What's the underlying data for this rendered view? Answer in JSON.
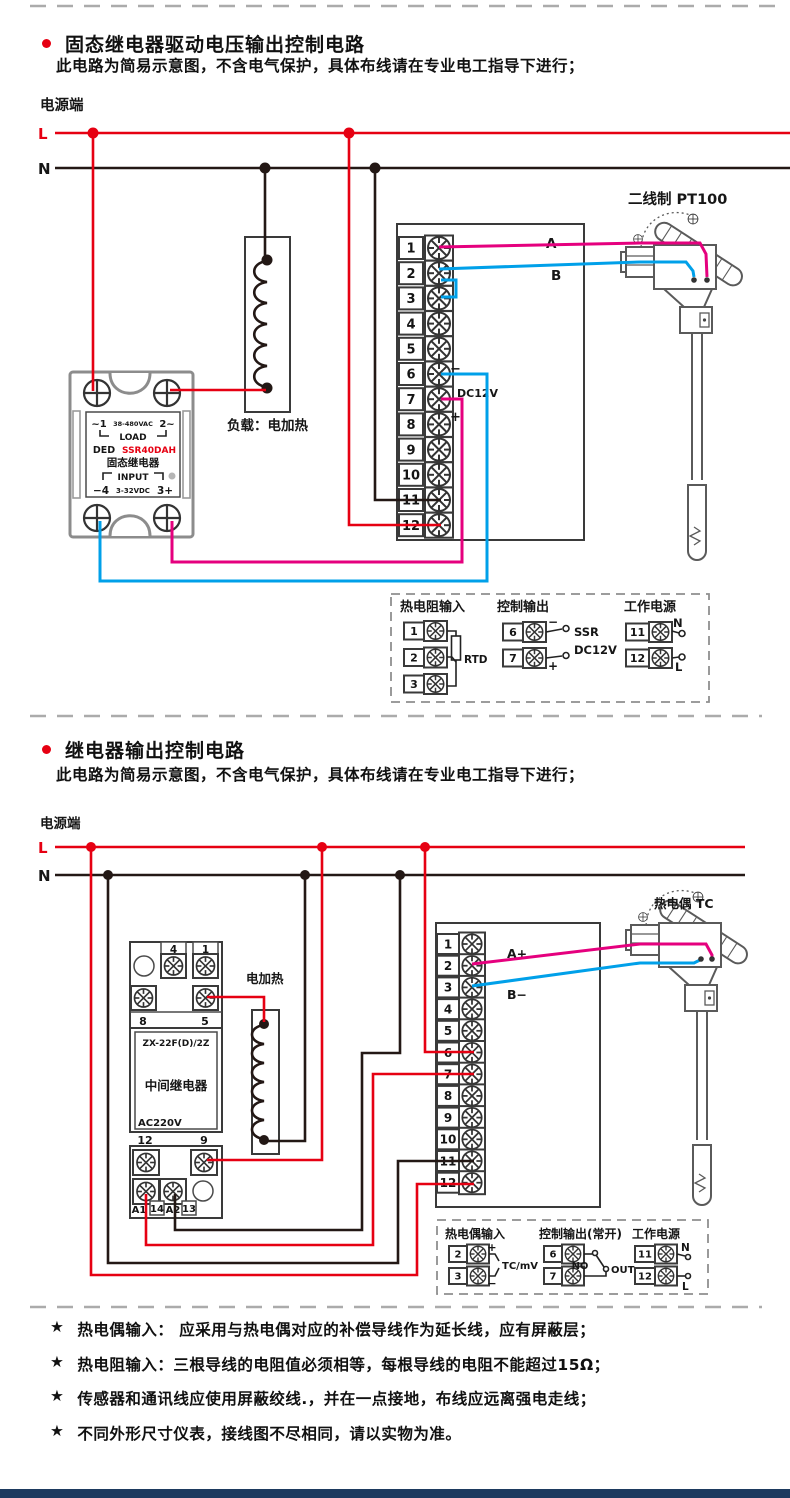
{
  "colors": {
    "wire_live": "#e60012",
    "wire_neutral": "#231815",
    "wire_sensor_a": "#e5007e",
    "wire_sensor_b": "#00a0e9",
    "accent": "#e60012",
    "footer_bar": "#1d3a5f"
  },
  "section1": {
    "title": "固态继电器驱动电压输出控制电路",
    "subtitle": "此电路为简易示意图，不含电气保护，具体布线请在专业电工指导下进行；",
    "power_label": "电源端",
    "live_label": "L",
    "neutral_label": "N",
    "ssr": {
      "top_left": "~1",
      "voltage_ac": "38-480VAC",
      "top_right": "2~",
      "load": "LOAD",
      "brand": "DED",
      "model": "SSR40DAH",
      "name": "固态继电器",
      "input": "INPUT",
      "in_minus": "−4",
      "voltage_dc": "3-32VDC",
      "in_plus": "3+"
    },
    "load_label": "负载：电加热",
    "sensor_label": "二线制 PT100",
    "instrument": {
      "terminals": [
        "1",
        "2",
        "3",
        "4",
        "5",
        "6",
        "7",
        "8",
        "9",
        "10",
        "11",
        "12"
      ],
      "wire_a": "A",
      "wire_b": "B",
      "out_minus": "−",
      "out_plus": "+",
      "out_voltage": "DC12V"
    },
    "legend": {
      "input_title": "热电阻输入",
      "input_terms": [
        "1",
        "2",
        "3"
      ],
      "input_label": "RTD",
      "output_title": "控制输出",
      "output_terms": [
        "6",
        "7"
      ],
      "output_minus": "−",
      "output_plus": "+",
      "output_line1": "SSR",
      "output_line2": "DC12V",
      "power_title": "工作电源",
      "power_terms": [
        "11",
        "12"
      ],
      "power_n": "N",
      "power_l": "L"
    }
  },
  "section2": {
    "title": "继电器输出控制电路",
    "subtitle": "此电路为简易示意图，不含电气保护，具体布线请在专业电工指导下进行；",
    "power_label": "电源端",
    "live_label": "L",
    "neutral_label": "N",
    "relay": {
      "top_terms": [
        "4",
        "1"
      ],
      "mid_terms": [
        "8",
        "5"
      ],
      "low_terms": [
        "12",
        "9"
      ],
      "bottom_terms": [
        "A1",
        "14",
        "A2",
        "13"
      ],
      "model": "ZX-22F(D)/2Z",
      "name": "中间继电器",
      "voltage": "AC220V"
    },
    "heater_label": "电加热",
    "sensor_label": "热电偶 TC",
    "instrument": {
      "terminals": [
        "1",
        "2",
        "3",
        "4",
        "5",
        "6",
        "7",
        "8",
        "9",
        "10",
        "11",
        "12"
      ],
      "wire_a": "A+",
      "wire_b": "B−"
    },
    "legend": {
      "input_title": "热电偶输入",
      "input_terms": [
        "2",
        "3"
      ],
      "input_plus": "+",
      "input_minus": "−",
      "input_label": "TC/mV",
      "output_title": "控制输出(常开)",
      "output_terms": [
        "6",
        "7"
      ],
      "output_no": "NO",
      "output_out": "OUT",
      "power_title": "工作电源",
      "power_terms": [
        "11",
        "12"
      ],
      "power_n": "N",
      "power_l": "L"
    }
  },
  "footnotes": {
    "bullet": "★",
    "items": [
      "热电偶输入： 应采用与热电偶对应的补偿导线作为延长线，应有屏蔽层；",
      "热电阻输入：三根导线的电阻值必须相等，每根导线的电阻不能超过15Ω；",
      "传感器和通讯线应使用屏蔽绞线.，并在一点接地，布线应远离强电走线；",
      "不同外形尺寸仪表，接线图不尽相同，请以实物为准。"
    ]
  }
}
